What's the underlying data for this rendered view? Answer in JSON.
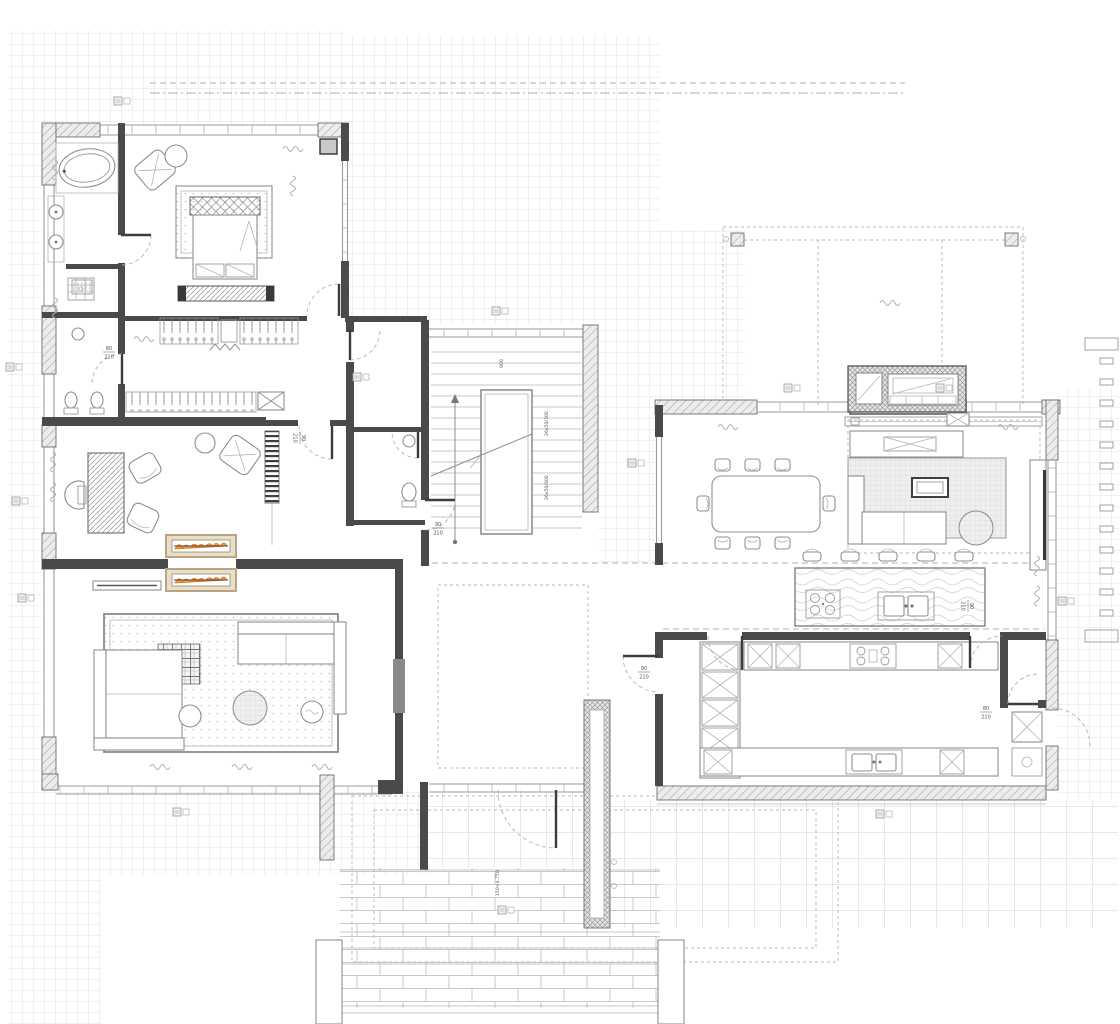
{
  "colors": {
    "wall": "#4a4a4a",
    "line": "#8f8f8f",
    "grid": "#dedede",
    "hatch": "#a3a3a3",
    "flame_orange": "#f6a13a",
    "flame_red": "#e2661f",
    "fireplace_frame": "#b9a585",
    "fireplace_fill": "#e9dfc8",
    "paper": "#ffffff"
  },
  "plan": {
    "door_labels": [
      {
        "w": "80",
        "h": "210",
        "x": 109,
        "y": 352,
        "rot": 0
      },
      {
        "w": "90",
        "h": "210",
        "x": 300,
        "y": 438,
        "rot": 90
      },
      {
        "w": "90",
        "h": "210",
        "x": 438,
        "y": 528,
        "rot": 0
      },
      {
        "w": "90",
        "h": "210",
        "x": 644,
        "y": 672,
        "rot": 0
      },
      {
        "w": "90",
        "h": "210",
        "x": 968,
        "y": 606,
        "rot": 90
      },
      {
        "w": "80",
        "h": "210",
        "x": 986,
        "y": 712,
        "rot": 0
      }
    ],
    "notes": [
      {
        "text": "26x50/300",
        "x": 548,
        "y": 436,
        "rot": -90
      },
      {
        "text": "26x50/300",
        "x": 548,
        "y": 500,
        "rot": -90
      },
      {
        "text": "900",
        "x": 503,
        "y": 368,
        "rot": -90
      },
      {
        "text": "150+4.750",
        "x": 499,
        "y": 896,
        "rot": -90
      }
    ],
    "tags": [
      {
        "x": 6,
        "y": 363
      },
      {
        "x": 12,
        "y": 497
      },
      {
        "x": 18,
        "y": 594
      },
      {
        "x": 114,
        "y": 97
      },
      {
        "x": 353,
        "y": 373
      },
      {
        "x": 492,
        "y": 307
      },
      {
        "x": 628,
        "y": 459
      },
      {
        "x": 784,
        "y": 384
      },
      {
        "x": 936,
        "y": 384
      },
      {
        "x": 1058,
        "y": 597
      },
      {
        "x": 876,
        "y": 810
      },
      {
        "x": 498,
        "y": 906
      },
      {
        "x": 173,
        "y": 808
      }
    ],
    "squiggles": [
      {
        "x": 283,
        "y": 146,
        "r": 0
      },
      {
        "x": 296,
        "y": 176,
        "r": 90
      },
      {
        "x": 58,
        "y": 160,
        "r": 90
      },
      {
        "x": 58,
        "y": 298,
        "r": 90
      },
      {
        "x": 134,
        "y": 336,
        "r": 0
      },
      {
        "x": 56,
        "y": 452,
        "r": 90
      },
      {
        "x": 56,
        "y": 482,
        "r": 90
      },
      {
        "x": 150,
        "y": 764,
        "r": 0
      },
      {
        "x": 232,
        "y": 764,
        "r": 0
      },
      {
        "x": 312,
        "y": 764,
        "r": 0
      },
      {
        "x": 718,
        "y": 424,
        "r": 0
      },
      {
        "x": 998,
        "y": 424,
        "r": 0
      },
      {
        "x": 1040,
        "y": 556,
        "r": 90
      },
      {
        "x": 1040,
        "y": 586,
        "r": 90
      },
      {
        "x": 880,
        "y": 300,
        "r": 0
      }
    ],
    "fence_slats": {
      "x": 1100,
      "y_start": 358,
      "step": 21,
      "count": 13,
      "w": 13,
      "h": 6
    },
    "symbols": [
      "bathtub",
      "washbasin",
      "toilet",
      "bidet",
      "shower-drain",
      "double-bed",
      "headboard",
      "bedside-bench",
      "wardrobe-hangers",
      "lounge-chair",
      "side-table",
      "desk",
      "office-chair",
      "armchair",
      "shelving-unit",
      "double-sided-fireplace",
      "sofa",
      "pouf",
      "plaid-throw",
      "area-rug",
      "dining-table",
      "dining-chair",
      "media-cabinet",
      "tv",
      "kitchen-island",
      "bar-stool",
      "cooktop",
      "kitchen-sink",
      "tall-cabinet",
      "staircase",
      "door-swing",
      "outdoor-fireplace",
      "pergola-column",
      "planter",
      "window",
      "terrace-paving"
    ]
  }
}
